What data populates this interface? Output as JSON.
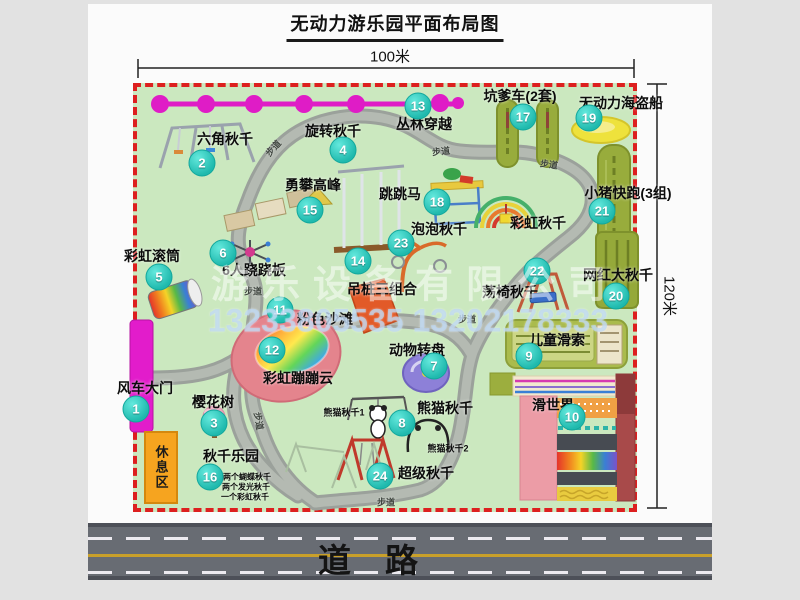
{
  "title": "无动力游乐园平面布局图",
  "dimensions": {
    "top": "100米",
    "right": "120米"
  },
  "road": {
    "label": "道路"
  },
  "watermark": {
    "company": "游乐设备有限公司",
    "phone": "13233805535 13202178333"
  },
  "park": {
    "rest_area": "休息区",
    "attractions": [
      {
        "num": 1,
        "label": "风车大门",
        "bx": 136,
        "by": 409,
        "lx": 145,
        "ly": 388
      },
      {
        "num": 2,
        "label": "六角秋千",
        "bx": 202,
        "by": 163,
        "lx": 225,
        "ly": 139
      },
      {
        "num": 3,
        "label": "樱花树",
        "bx": 214,
        "by": 423,
        "lx": 213,
        "ly": 402
      },
      {
        "num": 4,
        "label": "旋转秋千",
        "bx": 343,
        "by": 150,
        "lx": 333,
        "ly": 131
      },
      {
        "num": 5,
        "label": "彩虹滚筒",
        "bx": 159,
        "by": 277,
        "lx": 152,
        "ly": 256
      },
      {
        "num": 6,
        "label": "6人跷跷板",
        "bx": 223,
        "by": 253,
        "lx": 254,
        "ly": 270
      },
      {
        "num": 7,
        "label": "动物转盘",
        "bx": 434,
        "by": 366,
        "lx": 417,
        "ly": 350
      },
      {
        "num": 8,
        "label": "熊猫秋千",
        "bx": 402,
        "by": 423,
        "lx": 445,
        "ly": 408
      },
      {
        "num": 9,
        "label": "儿童滑索",
        "bx": 529,
        "by": 356,
        "lx": 557,
        "ly": 340
      },
      {
        "num": 10,
        "label": "滑世界",
        "bx": 572,
        "by": 417,
        "lx": 553,
        "ly": 405
      },
      {
        "num": 11,
        "label": "粉色沙滩",
        "bx": 280,
        "by": 310,
        "lx": 325,
        "ly": 319
      },
      {
        "num": 12,
        "label": "彩虹蹦蹦云",
        "bx": 272,
        "by": 350,
        "lx": 298,
        "ly": 378
      },
      {
        "num": 13,
        "label": "丛林穿越",
        "bx": 418,
        "by": 106,
        "lx": 424,
        "ly": 124
      },
      {
        "num": 14,
        "label": "吊桩三组合",
        "bx": 358,
        "by": 261,
        "lx": 382,
        "ly": 289
      },
      {
        "num": 15,
        "label": "勇攀高峰",
        "bx": 310,
        "by": 210,
        "lx": 313,
        "ly": 185
      },
      {
        "num": 16,
        "label": "秋千乐园",
        "bx": 210,
        "by": 477,
        "lx": 231,
        "ly": 456
      },
      {
        "num": 17,
        "label": "坑爹车(2套)",
        "bx": 523,
        "by": 117,
        "lx": 520,
        "ly": 96
      },
      {
        "num": 18,
        "label": "跳跳马",
        "bx": 437,
        "by": 202,
        "lx": 400,
        "ly": 194
      },
      {
        "num": 19,
        "label": "无动力海盗船",
        "bx": 589,
        "by": 118,
        "lx": 621,
        "ly": 103
      },
      {
        "num": 20,
        "label": "网红大秋千",
        "bx": 616,
        "by": 296,
        "lx": 618,
        "ly": 275
      },
      {
        "num": 21,
        "label": "小猪快跑(3组)",
        "bx": 602,
        "by": 211,
        "lx": 628,
        "ly": 193
      },
      {
        "num": 22,
        "label": "荡椅秋千",
        "bx": 537,
        "by": 271,
        "lx": 510,
        "ly": 292
      },
      {
        "num": 23,
        "label": "泡泡秋千",
        "bx": 401,
        "by": 243,
        "lx": 439,
        "ly": 229
      },
      {
        "num": 24,
        "label": "超级秋千",
        "bx": 380,
        "by": 476,
        "lx": 426,
        "ly": 473
      }
    ],
    "extra_labels": [
      {
        "text": "彩虹秋千",
        "x": 538,
        "y": 223,
        "sz": 14
      },
      {
        "text": "熊猫秋千1",
        "x": 344,
        "y": 412,
        "sz": 9
      },
      {
        "text": "熊猫秋千2",
        "x": 448,
        "y": 448,
        "sz": 9
      },
      {
        "text": "两个蝴蝶秋千",
        "x": 247,
        "y": 477,
        "sz": 8
      },
      {
        "text": "两个发光秋千",
        "x": 246,
        "y": 487,
        "sz": 8
      },
      {
        "text": "一个彩虹秋千",
        "x": 245,
        "y": 497,
        "sz": 8
      }
    ],
    "path_labels": [
      {
        "text": "步道",
        "x": 273,
        "y": 148,
        "r": -48
      },
      {
        "text": "步道",
        "x": 441,
        "y": 151,
        "r": -6
      },
      {
        "text": "步道",
        "x": 549,
        "y": 164,
        "r": 8
      },
      {
        "text": "步道",
        "x": 253,
        "y": 291,
        "r": 0
      },
      {
        "text": "步道",
        "x": 467,
        "y": 319,
        "r": 0
      },
      {
        "text": "步道",
        "x": 259,
        "y": 421,
        "r": 80
      },
      {
        "text": "步道",
        "x": 386,
        "y": 502,
        "r": 0
      }
    ]
  }
}
